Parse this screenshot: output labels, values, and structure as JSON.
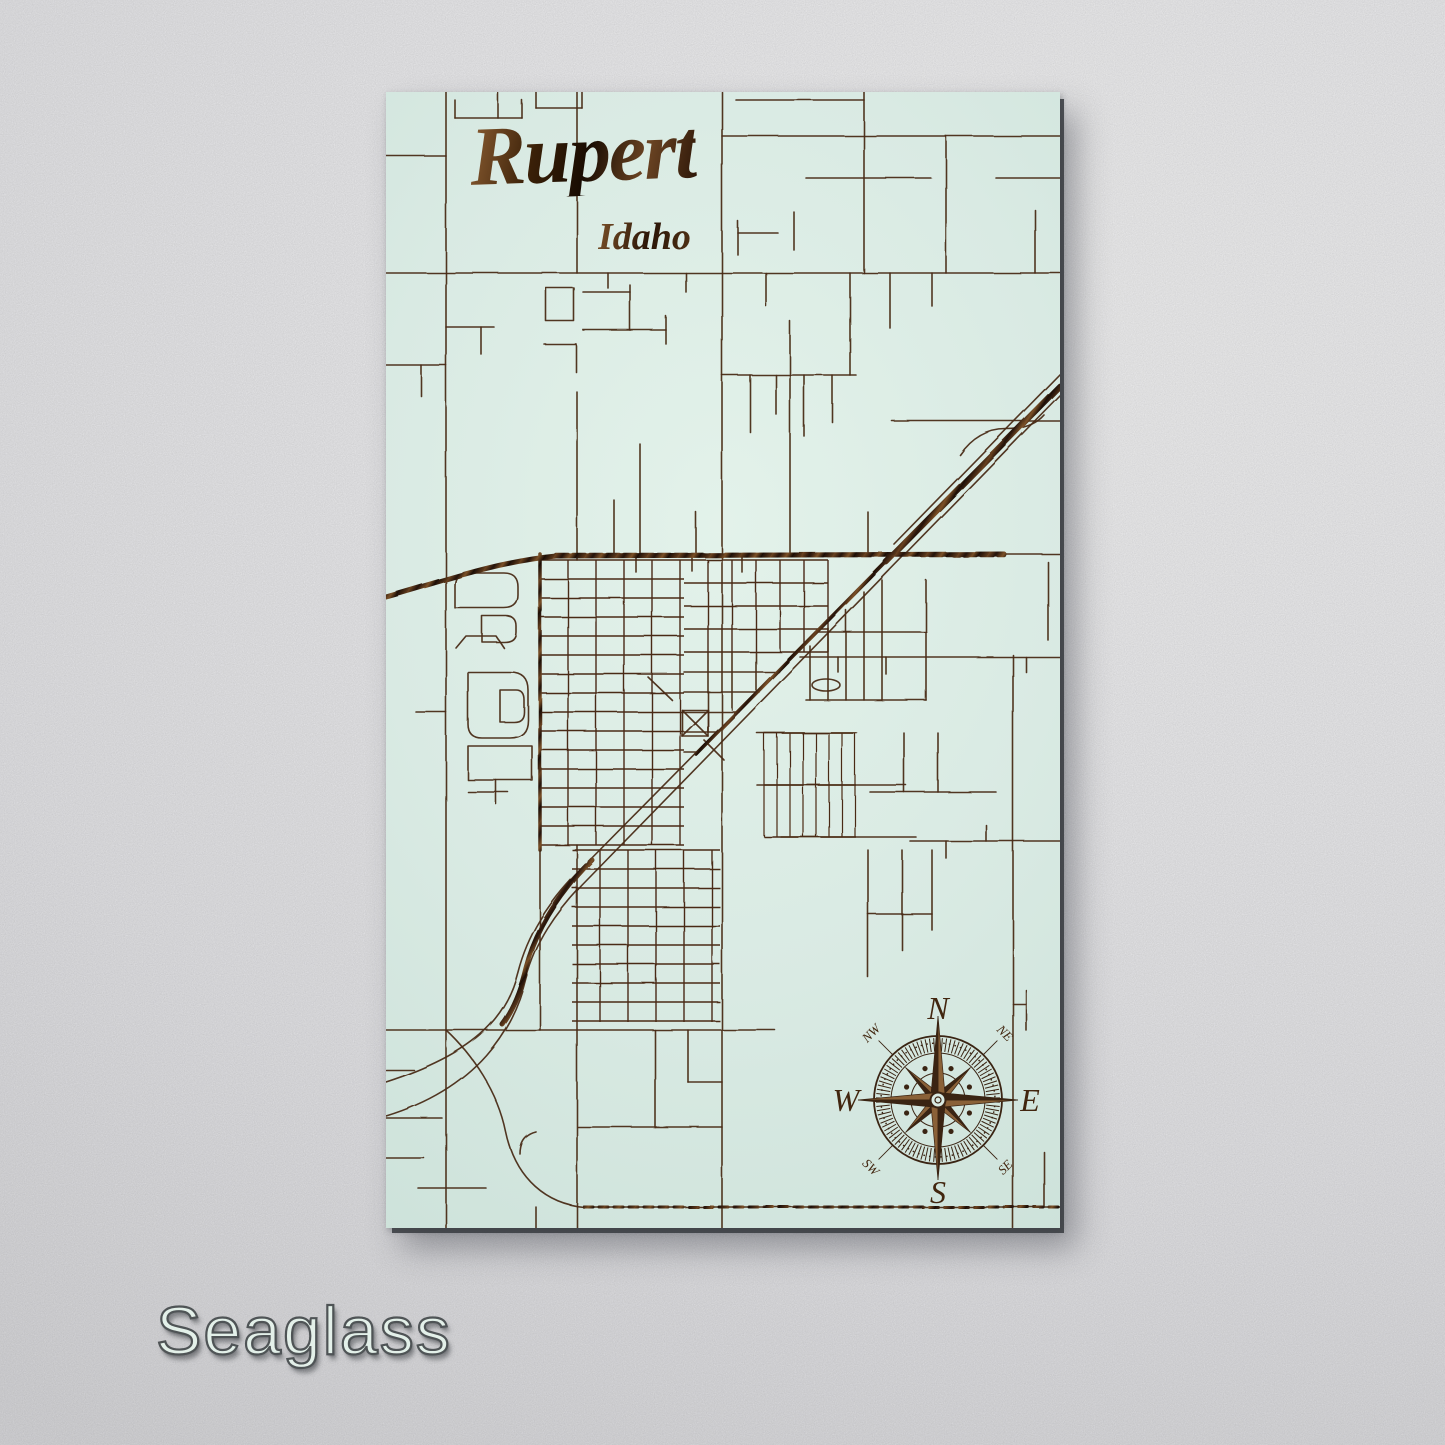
{
  "product": {
    "title": "Rupert",
    "subtitle": "Idaho",
    "variant_label": "Seaglass"
  },
  "compass": {
    "cx": 552,
    "cy": 1008,
    "r_outer": 64,
    "r_mid": 47,
    "r_inner": 27,
    "labels": {
      "n": "N",
      "e": "E",
      "s": "S",
      "w": "W",
      "ne": "NE",
      "nw": "NW",
      "se": "SE",
      "sw": "SW"
    }
  },
  "colors": {
    "wall": "#eeeef0",
    "panel_seaglass": "#d9eae3",
    "street_brown": "#4a2c17",
    "engrave_dark": "#23120a",
    "label_fill": "#e3f0e9",
    "label_stroke": "#4f5456"
  },
  "map_art": {
    "viewbox": [
      674,
      1136
    ],
    "streets": [
      "M60 0 V1136",
      "M191 0 V181",
      "M191 300 V468",
      "M191 753 V1136",
      "M336 0 V1136",
      "M478 0 V181",
      "M560 44 V181",
      "M649 118 V181",
      "M0 181 H674",
      "M0 64 H60",
      "M350 8 H478",
      "M336 44 H674",
      "M420 86 H545",
      "M610 86 H674",
      "M0 273 H60",
      "M35 273 V304",
      "M627 563 V1136",
      "M414 565 H674",
      "M524 749 H674",
      "M0 938 H389",
      "M620 462 H674",
      "M69 26 H136",
      "M69 8 V26",
      "M112 0 V26",
      "M136 8 V26",
      "M150 16 H196",
      "M150 0 V16",
      "M196 0 V16",
      "M60 235 H108",
      "M95 235 V262",
      "M160 196 H188 V229 H160 Z",
      "M158 252 H190",
      "M190 252 V280",
      "M197 200 H244",
      "M244 193 V238",
      "M197 238 H280",
      "M280 224 V252",
      "M222 181 V196",
      "M300 181 V200",
      "M404 229 V461",
      "M352 129 V163",
      "M352 141 H392",
      "M408 120 V158",
      "M254 352 V461",
      "M228 408 V461",
      "M310 420 V461",
      "M336 283 H470",
      "M364 283 V340",
      "M390 283 V322",
      "M418 283 V344",
      "M446 283 V330",
      "M464 181 V283",
      "M506 329 H674",
      "M546 181 V214",
      "M574 363 q18 -26 46 -26 q26 0 38 -14",
      "M482 420 V460",
      "M380 181 V214",
      "M504 181 V236",
      "M674 282 L508 452",
      "M426 593 a14 6 0 1 0 28 0 a14 6 0 1 0 -28 0",
      "M540 488 V608",
      "M432 540 H540",
      "M424 554 V608",
      "M442 536 V608",
      "M460 518 V608",
      "M478 500 V608",
      "M496 488 V608",
      "M420 608 H540",
      "M371 641 H471",
      "M371 693 H520",
      "M395 745 H530",
      "M484 700 H610",
      "M518 641 V700",
      "M552 641 V700",
      "M452 565 V580",
      "M500 565 V582",
      "M640 565 V580",
      "M662 470 V548",
      "M560 749 V766",
      "M600 733 V749",
      "M154 758 V938",
      "M296 618 H322 V644 H296 Z",
      "M296 618 L322 644",
      "M322 618 L296 644",
      "M262 585 L286 608",
      "M318 648 L338 668",
      "M250 462 V480",
      "M306 462 V479",
      "M356 463 V480",
      "M298 580 H393",
      "M298 600 H373",
      "M298 620 H353",
      "M298 640 H333",
      "M298 660 H313",
      "M322 560 V640",
      "M346 560 V618",
      "M370 560 V598",
      "M69 516 V494 Q69 481 82 481 H118 Q132 481 132 495 V503 Q132 516 118 516 Z",
      "M96 524 H120 Q130 524 130 534 V540 Q130 550 118 550 H96 Z",
      "M70 556 L80 544 H110 L118 556",
      "M82 580 H124 Q142 580 142 598 V628 Q142 646 124 646 H96 Q82 646 82 632 Z",
      "M114 598 H130 Q138 598 138 608 V620 Q138 630 128 630 H114 Z",
      "M82 654 H146 V688 H82 Z",
      "M82 700 H122",
      "M30 620 H60",
      "M110 688 V712",
      "M269 938 V1035",
      "M192 1035 H336",
      "M302 938 V990",
      "M302 990 H336",
      "M150 1040 Q134 1044 134 1062",
      "M482 758 V885",
      "M516 758 V858",
      "M546 758 V838",
      "M482 822 H546",
      "M640 898 V938",
      "M627 912 H640",
      "M658 1060 V1115",
      "M0 978 H28",
      "M0 1026 H56",
      "M0 1066 H38",
      "M32 1096 H100",
      "M60 938 C86 962 112 1000 120 1040 C130 1088 162 1112 198 1115",
      "M150 1115 V1136",
      "M674 292 L195 777 C160 812 141 845 132 880 C120 928 86 962 0 990",
      "M674 303 L203 786 C168 821 149 852 140 886 C128 936 92 996 0 1024",
      "M198 1115 H674"
    ],
    "bold": [
      {
        "d": "M0 505 C60 488 110 470 170 464 L618 462",
        "w": 5
      },
      {
        "d": "M674 294 L500 470",
        "w": 6
      },
      {
        "d": "M500 470 L310 662",
        "w": 3.5
      },
      {
        "d": "M206 768 C172 802 150 838 140 876 C135 897 128 916 116 932",
        "w": 5
      },
      {
        "d": "M154 462 V758",
        "w": 3.5
      },
      {
        "d": "M198 1115 H674",
        "w": 3,
        "dash": "9 6"
      },
      {
        "d": "M170 463 H618",
        "w": 4.5,
        "dash": "12 5"
      }
    ],
    "grids": [
      {
        "x1": 154,
        "x2": 298,
        "y1": 468,
        "y2": 753,
        "hstep": 19,
        "vx": [
          182,
          210,
          238,
          266,
          294
        ]
      },
      {
        "x1": 298,
        "x2": 442,
        "y1": 468,
        "y2": 560,
        "hstep": 23,
        "vx": [
          322,
          346,
          370,
          394,
          418,
          442
        ]
      },
      {
        "x1": 378,
        "x2": 470,
        "y1": 641,
        "y2": 745,
        "hstep": 52,
        "vstep": 13
      },
      {
        "x1": 186,
        "x2": 334,
        "y1": 758,
        "y2": 930,
        "hstep": 19,
        "vx": [
          214,
          242,
          270,
          298,
          326
        ]
      }
    ]
  }
}
